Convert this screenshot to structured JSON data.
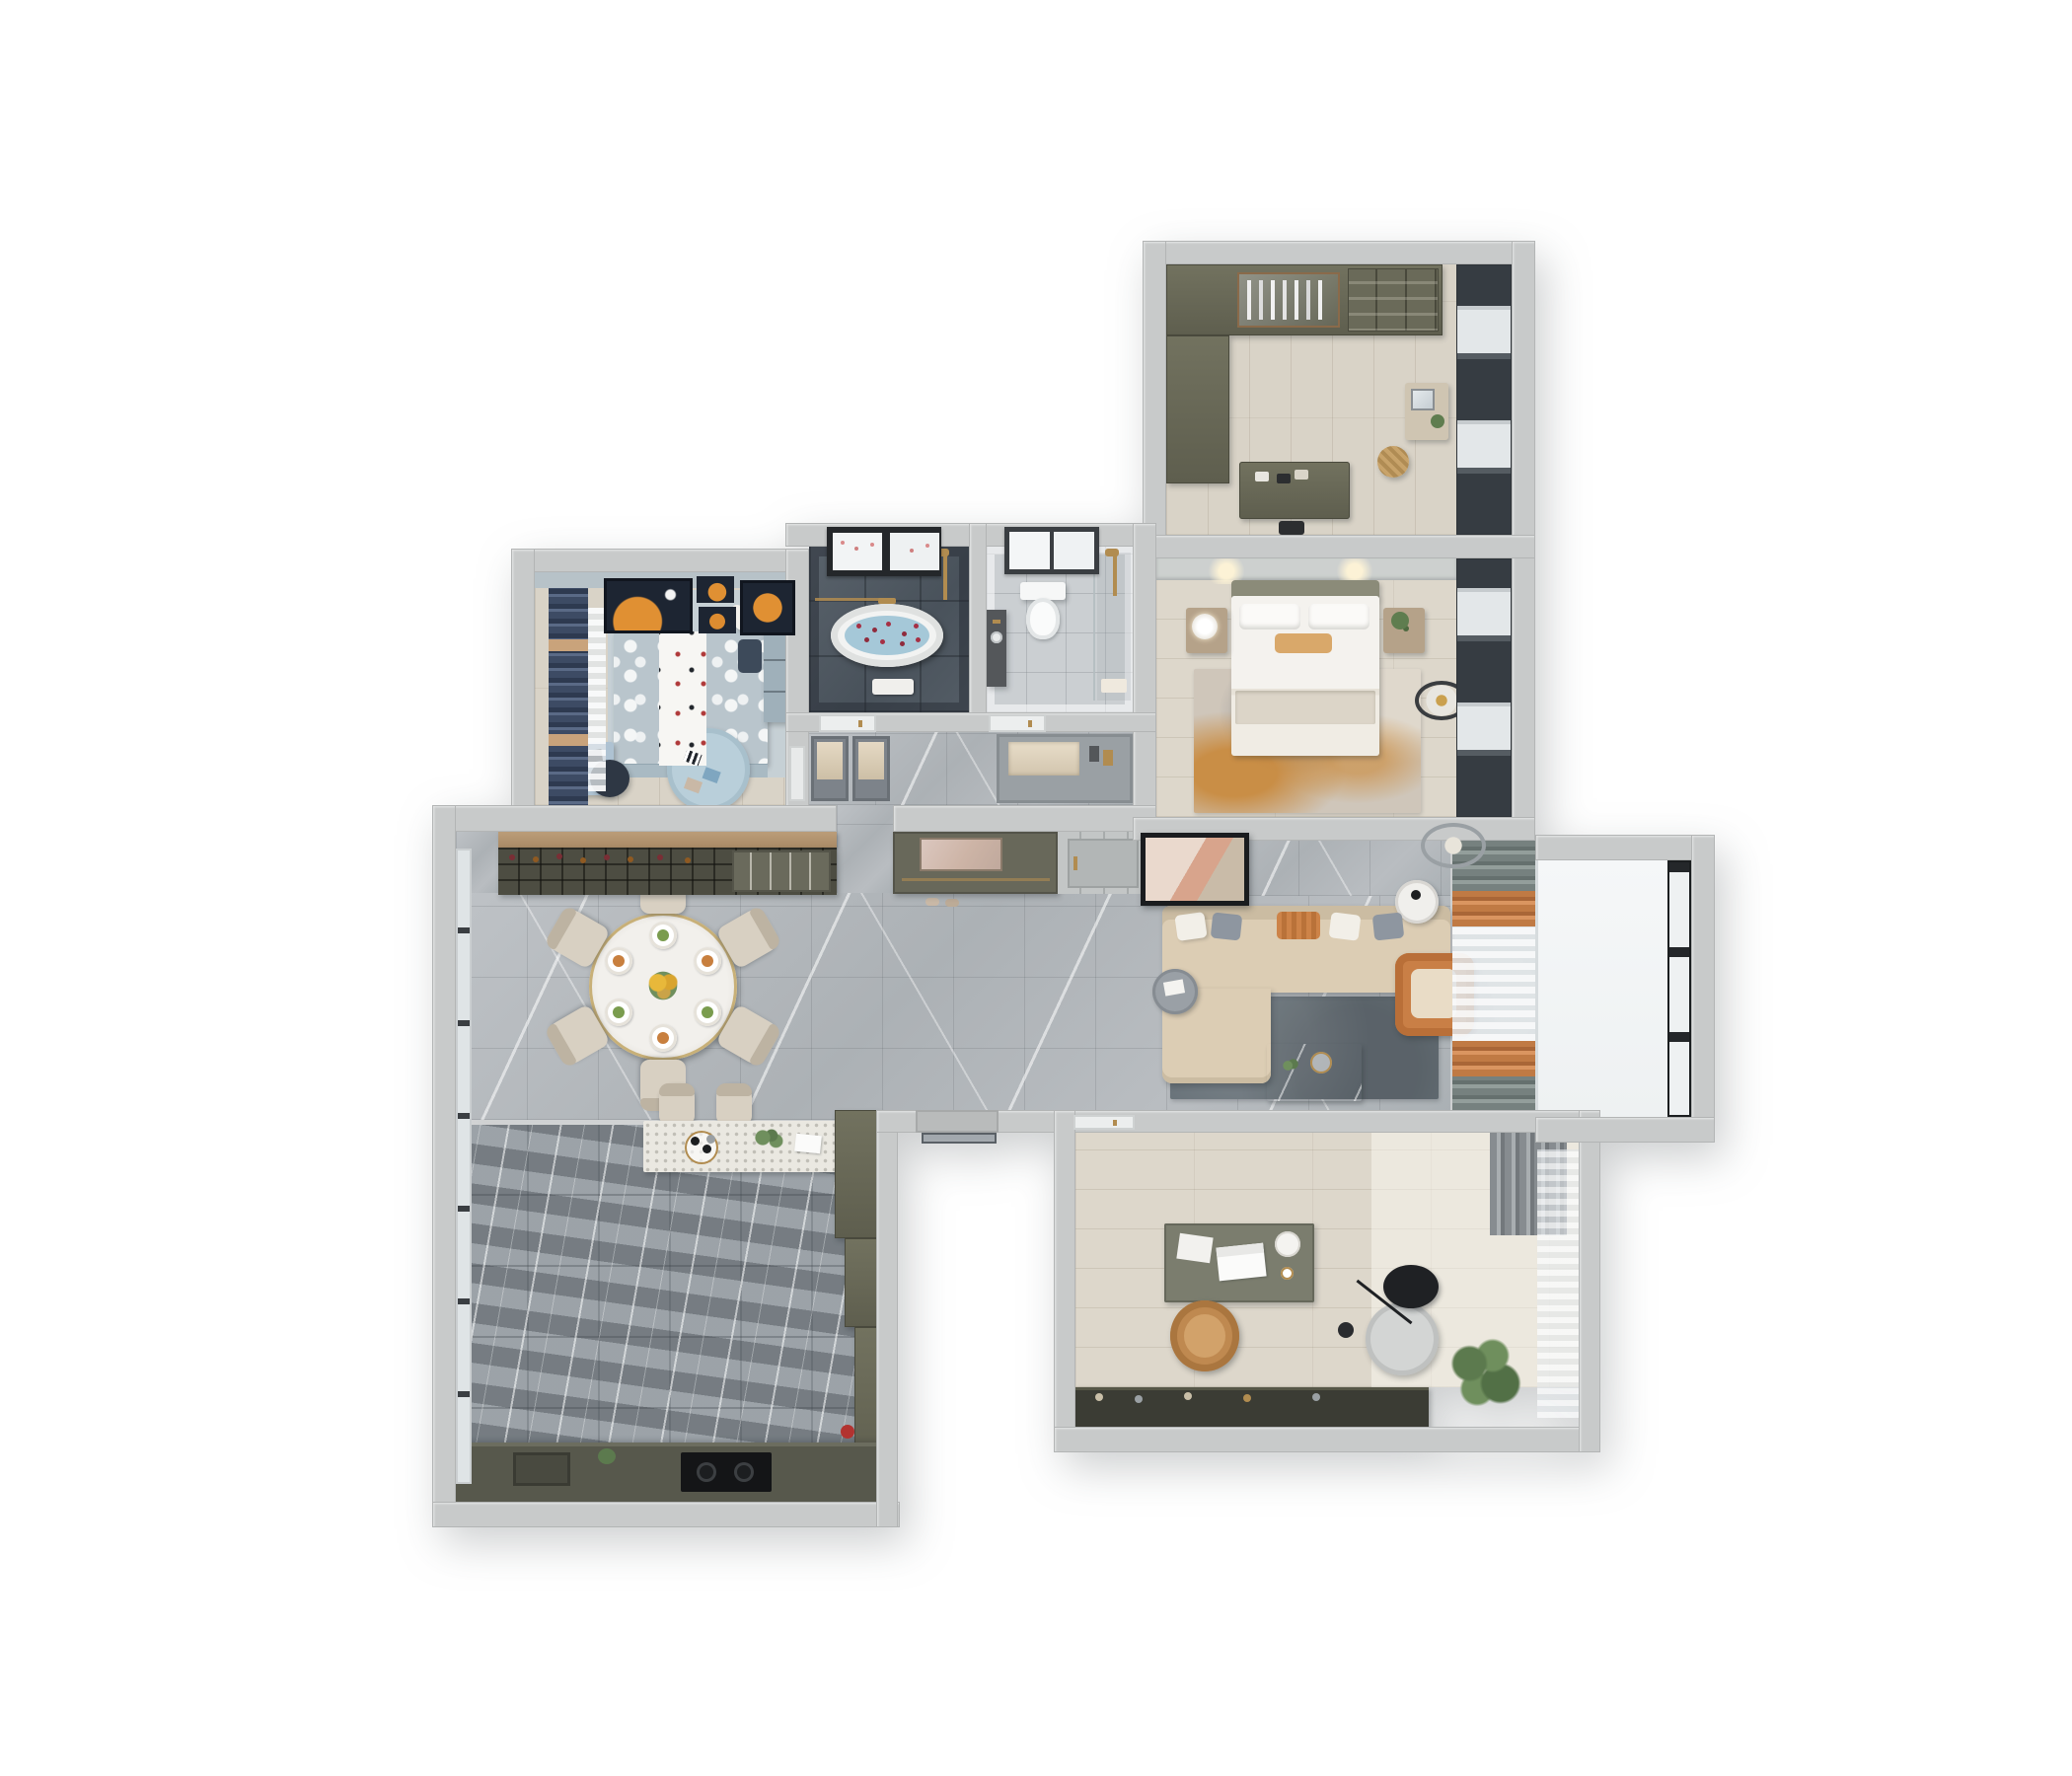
{
  "scene": {
    "description": "Top-down 3D dollhouse render of a furnished apartment floor plan on a white background",
    "background": "#ffffff",
    "visible_text": "none"
  },
  "palette": {
    "wall_gray": "#c8caca",
    "wood_floor": "#d9d3c7",
    "marble_floor": "#b5b9bd",
    "kitchen_band_tile": "#949ba1",
    "slate_bath": "#515a63",
    "olive_cabinet": "#68685a",
    "wine_cabinet": "#4d4d42",
    "sofa_beige": "#dccdb4",
    "rug_dark_gray": "#667077",
    "accent_orange": "#c97f46",
    "accent_gold": "#b18c50",
    "kids_navy_curtain": "#3d4b64",
    "kids_bed_blue": "#b9c5cc",
    "balcony_white": "#f3f5f6",
    "window_frame_black": "#24272a"
  },
  "rooms": [
    {
      "id": "walk-in-closet",
      "label": "Walk-in closet",
      "furniture": [
        "wardrobe wall with glass doors",
        "open shelving with bags and shoes",
        "island dresser",
        "vanity table with mirror",
        "rattan basket",
        "window blinds"
      ]
    },
    {
      "id": "master-bedroom",
      "label": "Master bedroom",
      "furniture": [
        "double bed with white duvet",
        "orange accent pillow",
        "two nightstands",
        "table lamp",
        "potted plant",
        "abstract orange area rug",
        "ceiling lamp",
        "window blinds"
      ]
    },
    {
      "id": "bathroom-primary",
      "label": "Primary bathroom",
      "furniture": [
        "freestanding oval bathtub with rose petals",
        "gold shower set",
        "black framed window",
        "glass screen",
        "bath mat"
      ]
    },
    {
      "id": "bathroom-guest",
      "label": "Guest bathroom",
      "furniture": [
        "toilet",
        "dark vanity with gold faucet",
        "walk-in shower with gold fixtures",
        "window"
      ]
    },
    {
      "id": "kids-bedroom",
      "label": "Kids bedroom",
      "furniture": [
        "polka-dot bed with white runner",
        "teddy bear",
        "navy curtains",
        "wardrobe",
        "study desk",
        "desk chair",
        "round play rug with toys",
        "four orange-moon wall art frames"
      ]
    },
    {
      "id": "hallway",
      "label": "Hallway",
      "furniture": [
        "two bathroom doors",
        "display cabinets",
        "storage niche"
      ]
    },
    {
      "id": "foyer",
      "label": "Entry foyer",
      "furniture": [
        "shoe cabinet with mirrored niche",
        "entry door",
        "slippers"
      ]
    },
    {
      "id": "dining-room",
      "label": "Dining room",
      "furniture": [
        "round dining table with gold rim",
        "six upholstered chairs",
        "six place settings",
        "yellow flower centerpiece",
        "wine cabinet with bottle racks"
      ]
    },
    {
      "id": "kitchen",
      "label": "Kitchen",
      "furniture": [
        "white breakfast-bar island",
        "two bar stools",
        "coffee tray",
        "base cabinet run with cooktop",
        "stepped tall cabinet",
        "full-height windows"
      ]
    },
    {
      "id": "living-room",
      "label": "Living room",
      "furniture": [
        "beige L-shaped sectional sofa",
        "throw pillows",
        "leaning abstract artwork",
        "dark marble coffee table",
        "orange leather armchair",
        "round white side table",
        "round gray side table",
        "dark gray area rug",
        "layered curtains",
        "ceiling lamp"
      ]
    },
    {
      "id": "balcony",
      "label": "Living room balcony",
      "furniture": [
        "floor-to-ceiling black framed windows"
      ]
    },
    {
      "id": "study",
      "label": "Study",
      "furniture": [
        "writing desk",
        "white laptop",
        "camel office chair",
        "gray lounge chair",
        "black arc floor lamp",
        "potted plant",
        "low charcoal cabinet",
        "sheer curtain",
        "gray curtain"
      ]
    },
    {
      "id": "service-door",
      "label": "Service doorway",
      "furniture": [
        "glass door"
      ]
    }
  ]
}
